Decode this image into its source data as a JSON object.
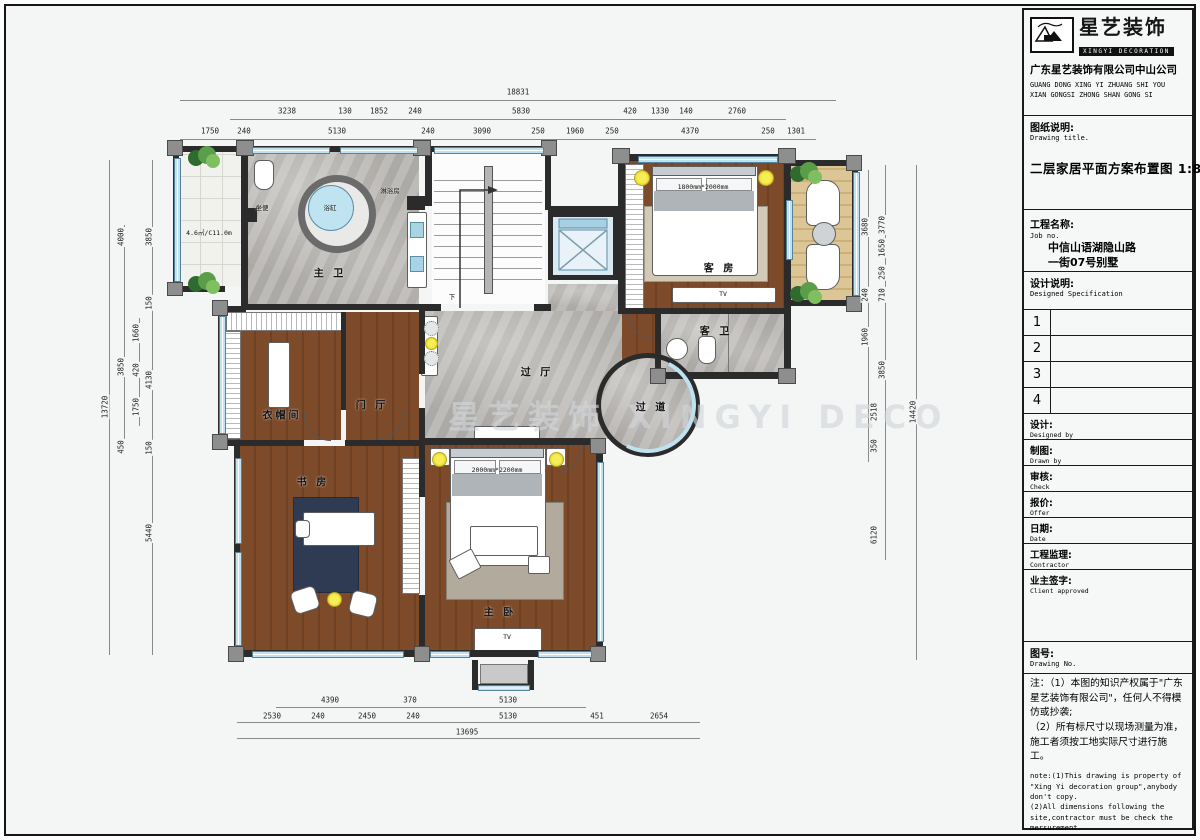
{
  "colors": {
    "wall": "#2b2b2b",
    "wood": "#7d4b2a",
    "marble": "#b6b3af",
    "window": "#bfe2f1",
    "deck": "#dcc696",
    "plant": "#4e8f3d",
    "light": "#f2e63e",
    "accent_black": "#111111"
  },
  "title_block": {
    "brand_cn": "星艺装饰",
    "brand_en": "XINGYI DECORATION",
    "company_cn": "广东星艺装饰有限公司中山公司",
    "company_en1": "GUANG DONG XING YI ZHUANG SHI YOU",
    "company_en2": "XIAN GONGSI ZHONG SHAN GONG SI",
    "drawing_title_label": "图纸说明:",
    "drawing_title_label_en": "Drawing title.",
    "drawing_title": "二层家居平面方案布置图 1:85",
    "job_label": "工程名称:",
    "job_label_en": "Job  no.",
    "job_line1": "中信山语湖隐山路",
    "job_line2": "一街07号别墅",
    "spec_label": "设计说明:",
    "spec_label_en": "Designed Specification",
    "rev_rows": [
      "1",
      "2",
      "3",
      "4"
    ],
    "fields": [
      {
        "cn": "设计:",
        "en": "Designed by"
      },
      {
        "cn": "制图:",
        "en": "Drawn by"
      },
      {
        "cn": "审核:",
        "en": "Check"
      },
      {
        "cn": "报价:",
        "en": "Offer"
      },
      {
        "cn": "日期:",
        "en": "Date"
      },
      {
        "cn": "工程监理:",
        "en": "Contractor"
      },
      {
        "cn": "业主签字:",
        "en": "Client approved"
      }
    ],
    "drawing_no_label": "图号:",
    "drawing_no_label_en": "Drawing No.",
    "note_cn": "注：（1）本图的知识产权属于\"广东星艺装饰有限公司\"，任何人不得模仿或抄袭;\n（2）所有标尺寸以现场测量为准，施工者须按工地实际尺寸进行施工。",
    "note_en": "note:(1)This drawing is property of \"Xing Yi decoration group\",anybody don't copy.\n(2)All dimensions following the site,contractor must be check the mersurement."
  },
  "plan": {
    "watermark": "星艺装饰 XINGYI DECO",
    "room_labels": [
      {
        "t": "主 卫",
        "x": 330,
        "y": 272
      },
      {
        "t": "衣帽间",
        "x": 282,
        "y": 414
      },
      {
        "t": "门 厅",
        "x": 372,
        "y": 404
      },
      {
        "t": "过 厅",
        "x": 537,
        "y": 371
      },
      {
        "t": "过 道",
        "x": 652,
        "y": 406
      },
      {
        "t": "书 房",
        "x": 313,
        "y": 481
      },
      {
        "t": "主 卧",
        "x": 500,
        "y": 611
      },
      {
        "t": "客 房",
        "x": 720,
        "y": 267
      },
      {
        "t": "客 卫",
        "x": 716,
        "y": 330
      }
    ],
    "small_labels": [
      {
        "t": "下",
        "x": 452,
        "y": 296
      },
      {
        "t": "浴缸",
        "x": 330,
        "y": 207
      },
      {
        "t": "坐便",
        "x": 262,
        "y": 207
      },
      {
        "t": "淋浴房",
        "x": 390,
        "y": 190
      },
      {
        "t": "4.6㎡/C11.0m",
        "x": 209,
        "y": 232
      },
      {
        "t": "1800mm*2000mm",
        "x": 703,
        "y": 187
      },
      {
        "t": "TV",
        "x": 723,
        "y": 294
      },
      {
        "t": "2000mm*2200mm",
        "x": 497,
        "y": 470
      },
      {
        "t": "TV",
        "x": 507,
        "y": 637
      }
    ],
    "dims": {
      "top": [
        {
          "v": "18831",
          "x": 518,
          "y": 92
        },
        {
          "v": "3238",
          "x": 287,
          "y": 111
        },
        {
          "v": "130",
          "x": 345,
          "y": 111
        },
        {
          "v": "1852",
          "x": 379,
          "y": 111
        },
        {
          "v": "240",
          "x": 415,
          "y": 111
        },
        {
          "v": "5830",
          "x": 521,
          "y": 111
        },
        {
          "v": "420",
          "x": 630,
          "y": 111
        },
        {
          "v": "1330",
          "x": 660,
          "y": 111
        },
        {
          "v": "140",
          "x": 686,
          "y": 111
        },
        {
          "v": "2760",
          "x": 737,
          "y": 111
        },
        {
          "v": "1750",
          "x": 210,
          "y": 131
        },
        {
          "v": "240",
          "x": 244,
          "y": 131
        },
        {
          "v": "5130",
          "x": 337,
          "y": 131
        },
        {
          "v": "240",
          "x": 428,
          "y": 131
        },
        {
          "v": "3090",
          "x": 482,
          "y": 131
        },
        {
          "v": "250",
          "x": 538,
          "y": 131
        },
        {
          "v": "1960",
          "x": 575,
          "y": 131
        },
        {
          "v": "250",
          "x": 612,
          "y": 131
        },
        {
          "v": "4370",
          "x": 690,
          "y": 131
        },
        {
          "v": "250",
          "x": 768,
          "y": 131
        },
        {
          "v": "1301",
          "x": 796,
          "y": 131
        }
      ],
      "left": [
        {
          "v": "13720",
          "x": 105,
          "y": 407,
          "r": 1
        },
        {
          "v": "4000",
          "x": 121,
          "y": 237,
          "r": 1
        },
        {
          "v": "3850",
          "x": 121,
          "y": 367,
          "r": 1
        },
        {
          "v": "450",
          "x": 121,
          "y": 447,
          "r": 1
        },
        {
          "v": "1660",
          "x": 136,
          "y": 333,
          "r": 1
        },
        {
          "v": "420",
          "x": 136,
          "y": 370,
          "r": 1
        },
        {
          "v": "1750",
          "x": 136,
          "y": 407,
          "r": 1
        },
        {
          "v": "3850",
          "x": 149,
          "y": 237,
          "r": 1
        },
        {
          "v": "150",
          "x": 149,
          "y": 303,
          "r": 1
        },
        {
          "v": "4130",
          "x": 149,
          "y": 380,
          "r": 1
        },
        {
          "v": "150",
          "x": 149,
          "y": 448,
          "r": 1
        },
        {
          "v": "5440",
          "x": 149,
          "y": 533,
          "r": 1
        }
      ],
      "right": [
        {
          "v": "3680",
          "x": 865,
          "y": 227,
          "r": 1
        },
        {
          "v": "240",
          "x": 865,
          "y": 295,
          "r": 1
        },
        {
          "v": "1960",
          "x": 865,
          "y": 337,
          "r": 1
        },
        {
          "v": "2518",
          "x": 874,
          "y": 412,
          "r": 1
        },
        {
          "v": "350",
          "x": 874,
          "y": 446,
          "r": 1
        },
        {
          "v": "6120",
          "x": 874,
          "y": 535,
          "r": 1
        },
        {
          "v": "3770",
          "x": 882,
          "y": 225,
          "r": 1
        },
        {
          "v": "1650",
          "x": 882,
          "y": 248,
          "r": 1
        },
        {
          "v": "250",
          "x": 882,
          "y": 273,
          "r": 1
        },
        {
          "v": "710",
          "x": 882,
          "y": 295,
          "r": 1
        },
        {
          "v": "3850",
          "x": 882,
          "y": 370,
          "r": 1
        },
        {
          "v": "14420",
          "x": 913,
          "y": 412,
          "r": 1
        }
      ],
      "bottom": [
        {
          "v": "4390",
          "x": 330,
          "y": 700
        },
        {
          "v": "370",
          "x": 410,
          "y": 700
        },
        {
          "v": "5130",
          "x": 508,
          "y": 700
        },
        {
          "v": "2530",
          "x": 272,
          "y": 716
        },
        {
          "v": "240",
          "x": 318,
          "y": 716
        },
        {
          "v": "2450",
          "x": 367,
          "y": 716
        },
        {
          "v": "240",
          "x": 413,
          "y": 716
        },
        {
          "v": "5130",
          "x": 508,
          "y": 716
        },
        {
          "v": "451",
          "x": 597,
          "y": 716
        },
        {
          "v": "2654",
          "x": 659,
          "y": 716
        },
        {
          "v": "13695",
          "x": 467,
          "y": 732
        }
      ]
    }
  }
}
